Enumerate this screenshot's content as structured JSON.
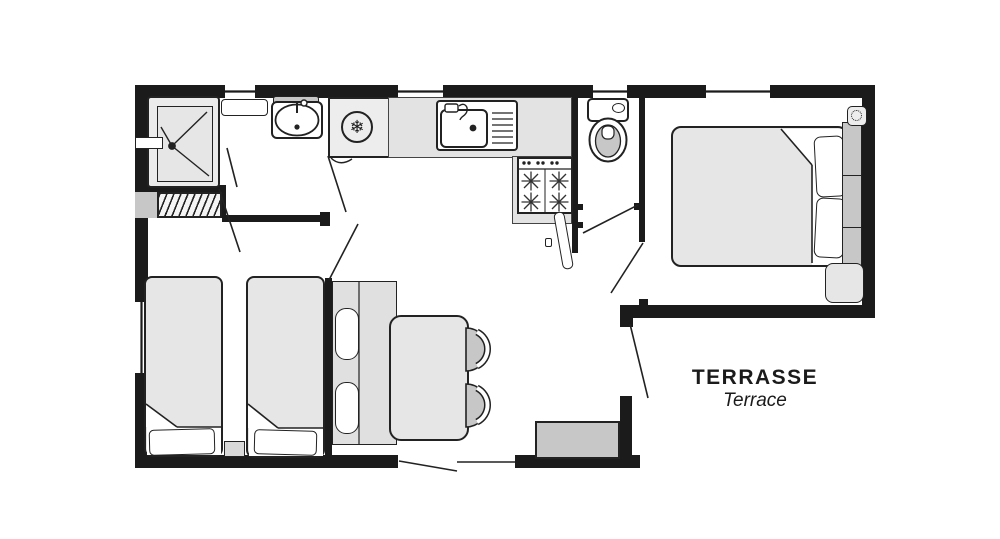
{
  "labels": {
    "terrace_title": "TERRASSE",
    "terrace_subtitle": "Terrace"
  },
  "glyphs": {
    "snowflake": "❄"
  },
  "colors": {
    "wall": "#1b1b1b",
    "line": "#222222",
    "furniture_light": "#e6e6e6",
    "furniture_mid": "#c7c7c7",
    "counter": "#e3e3e3",
    "bg": "#ffffff"
  }
}
